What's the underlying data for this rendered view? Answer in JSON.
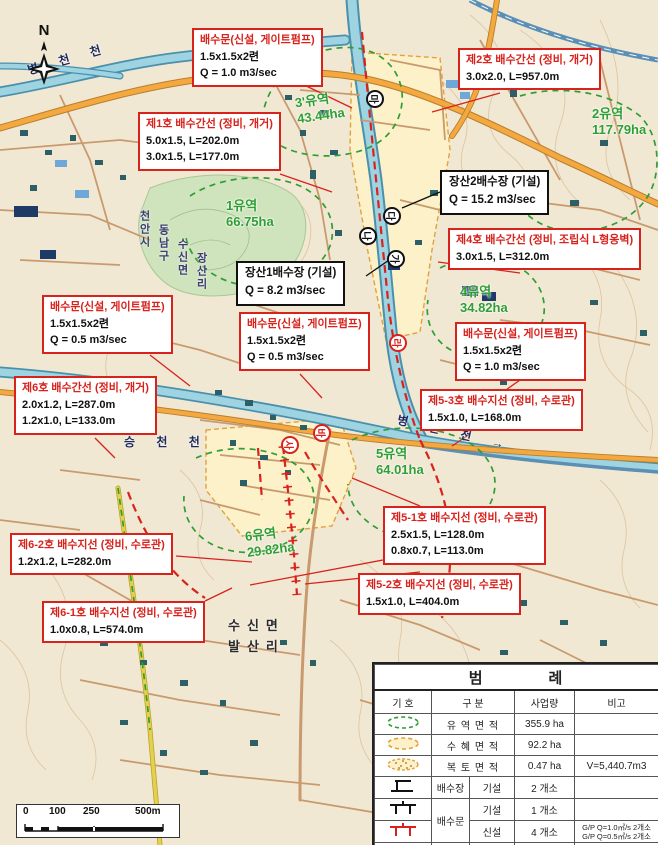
{
  "map": {
    "compass_label": "N",
    "rivers": {
      "byeongcheon_top": "병 천 천",
      "seungcheon": "승 천 천",
      "byeongcheon_right": "병 천 천 →"
    },
    "places": {
      "admin_lines": [
        "천안시",
        "동남구",
        "수신면",
        "장산리"
      ],
      "village_line1": "수신면",
      "village_line2": "발산리"
    },
    "basins": [
      {
        "name": "3'유역",
        "area": "43.44ha"
      },
      {
        "name": "2유역",
        "area": "117.79ha"
      },
      {
        "name": "1유역",
        "area": "66.75ha"
      },
      {
        "name": "4유역",
        "area": "34.82ha"
      },
      {
        "name": "5유역",
        "area": "64.01ha"
      },
      {
        "name": "6유역",
        "area": "29.82ha"
      }
    ],
    "markers": [
      "마",
      "다",
      "나",
      "가",
      "라",
      "바",
      "사"
    ],
    "callouts": [
      {
        "title": "배수문(신설, 게이트펌프)",
        "lines": [
          "1.5x1.5x2련",
          "Q = 1.0 m3/sec"
        ]
      },
      {
        "title": "제2호 배수간선 (정비, 개거)",
        "lines": [
          "3.0x2.0, L=957.0m"
        ]
      },
      {
        "title": "제1호 배수간선 (정비, 개거)",
        "lines": [
          "5.0x1.5, L=202.0m",
          "3.0x1.5, L=177.0m"
        ]
      },
      {
        "title": "제4호 배수간선 (정비, 조립식 L형옹벽)",
        "lines": [
          "3.0x1.5, L=312.0m"
        ]
      },
      {
        "title": "배수문(신설, 게이트펌프)",
        "lines": [
          "1.5x1.5x2련",
          "Q = 0.5 m3/sec"
        ]
      },
      {
        "title": "배수문(신설, 게이트펌프)",
        "lines": [
          "1.5x1.5x2련",
          "Q = 0.5 m3/sec"
        ]
      },
      {
        "title": "배수문(신설, 게이트펌프)",
        "lines": [
          "1.5x1.5x2련",
          "Q = 1.0 m3/sec"
        ]
      },
      {
        "title": "제6호 배수간선 (정비, 개거)",
        "lines": [
          "2.0x1.2, L=287.0m",
          "1.2x1.0, L=133.0m"
        ]
      },
      {
        "title": "제5-3호 배수지선 (정비, 수로관)",
        "lines": [
          "1.5x1.0, L=168.0m"
        ]
      },
      {
        "title": "제5-1호 배수지선 (정비, 수로관)",
        "lines": [
          "2.5x1.5, L=128.0m",
          "0.8x0.7, L=113.0m"
        ]
      },
      {
        "title": "제5-2호 배수지선 (정비, 수로관)",
        "lines": [
          "1.5x1.0, L=404.0m"
        ]
      },
      {
        "title": "제6-2호 배수지선 (정비, 수로관)",
        "lines": [
          "1.2x1.2, L=282.0m"
        ]
      },
      {
        "title": "제6-1호 배수지선 (정비, 수로관)",
        "lines": [
          "1.0x0.8, L=574.0m"
        ]
      }
    ],
    "stations": [
      {
        "title": "장산2배수장 (기설)",
        "lines": [
          "Q = 15.2 m3/sec"
        ]
      },
      {
        "title": "장산1배수장 (기설)",
        "lines": [
          "Q = 8.2 m3/sec"
        ]
      }
    ]
  },
  "legend": {
    "title": [
      "범",
      "례"
    ],
    "headers": [
      "기 호",
      "구 분",
      "사업량",
      "비고"
    ],
    "rows": [
      {
        "label": "유 역 면 적",
        "qty": "355.9 ha",
        "remark": ""
      },
      {
        "label": "수 혜 면 적",
        "qty": "92.2 ha",
        "remark": ""
      },
      {
        "label": "복 토 면 적",
        "qty": "0.47 ha",
        "remark": "V=5,440.7m3"
      },
      {
        "label": "배수장",
        "sub": "기설",
        "qty": "2 개소",
        "remark": ""
      },
      {
        "label": "배수문",
        "sub": "기설",
        "qty": "1 개소",
        "remark": ""
      },
      {
        "sub": "신설",
        "qty": "4 개소",
        "remark1": "G/P Q=1.0㎥/s 2개소",
        "remark2": "G/P Q=0.5㎥/s 2개소"
      },
      {
        "label": "배수로",
        "sub": "신설 · 정비",
        "qty": "9조 3.74km",
        "remark": ""
      }
    ]
  },
  "scalebar": {
    "labels": [
      "0",
      "100",
      "250",
      "500m"
    ]
  },
  "colors": {
    "accent_red": "#d8231d",
    "basin_green": "#2f9e33",
    "zone_orange": "#e2a23b",
    "river_blue": "#8ecadb",
    "road_orange": "#f3a840"
  }
}
